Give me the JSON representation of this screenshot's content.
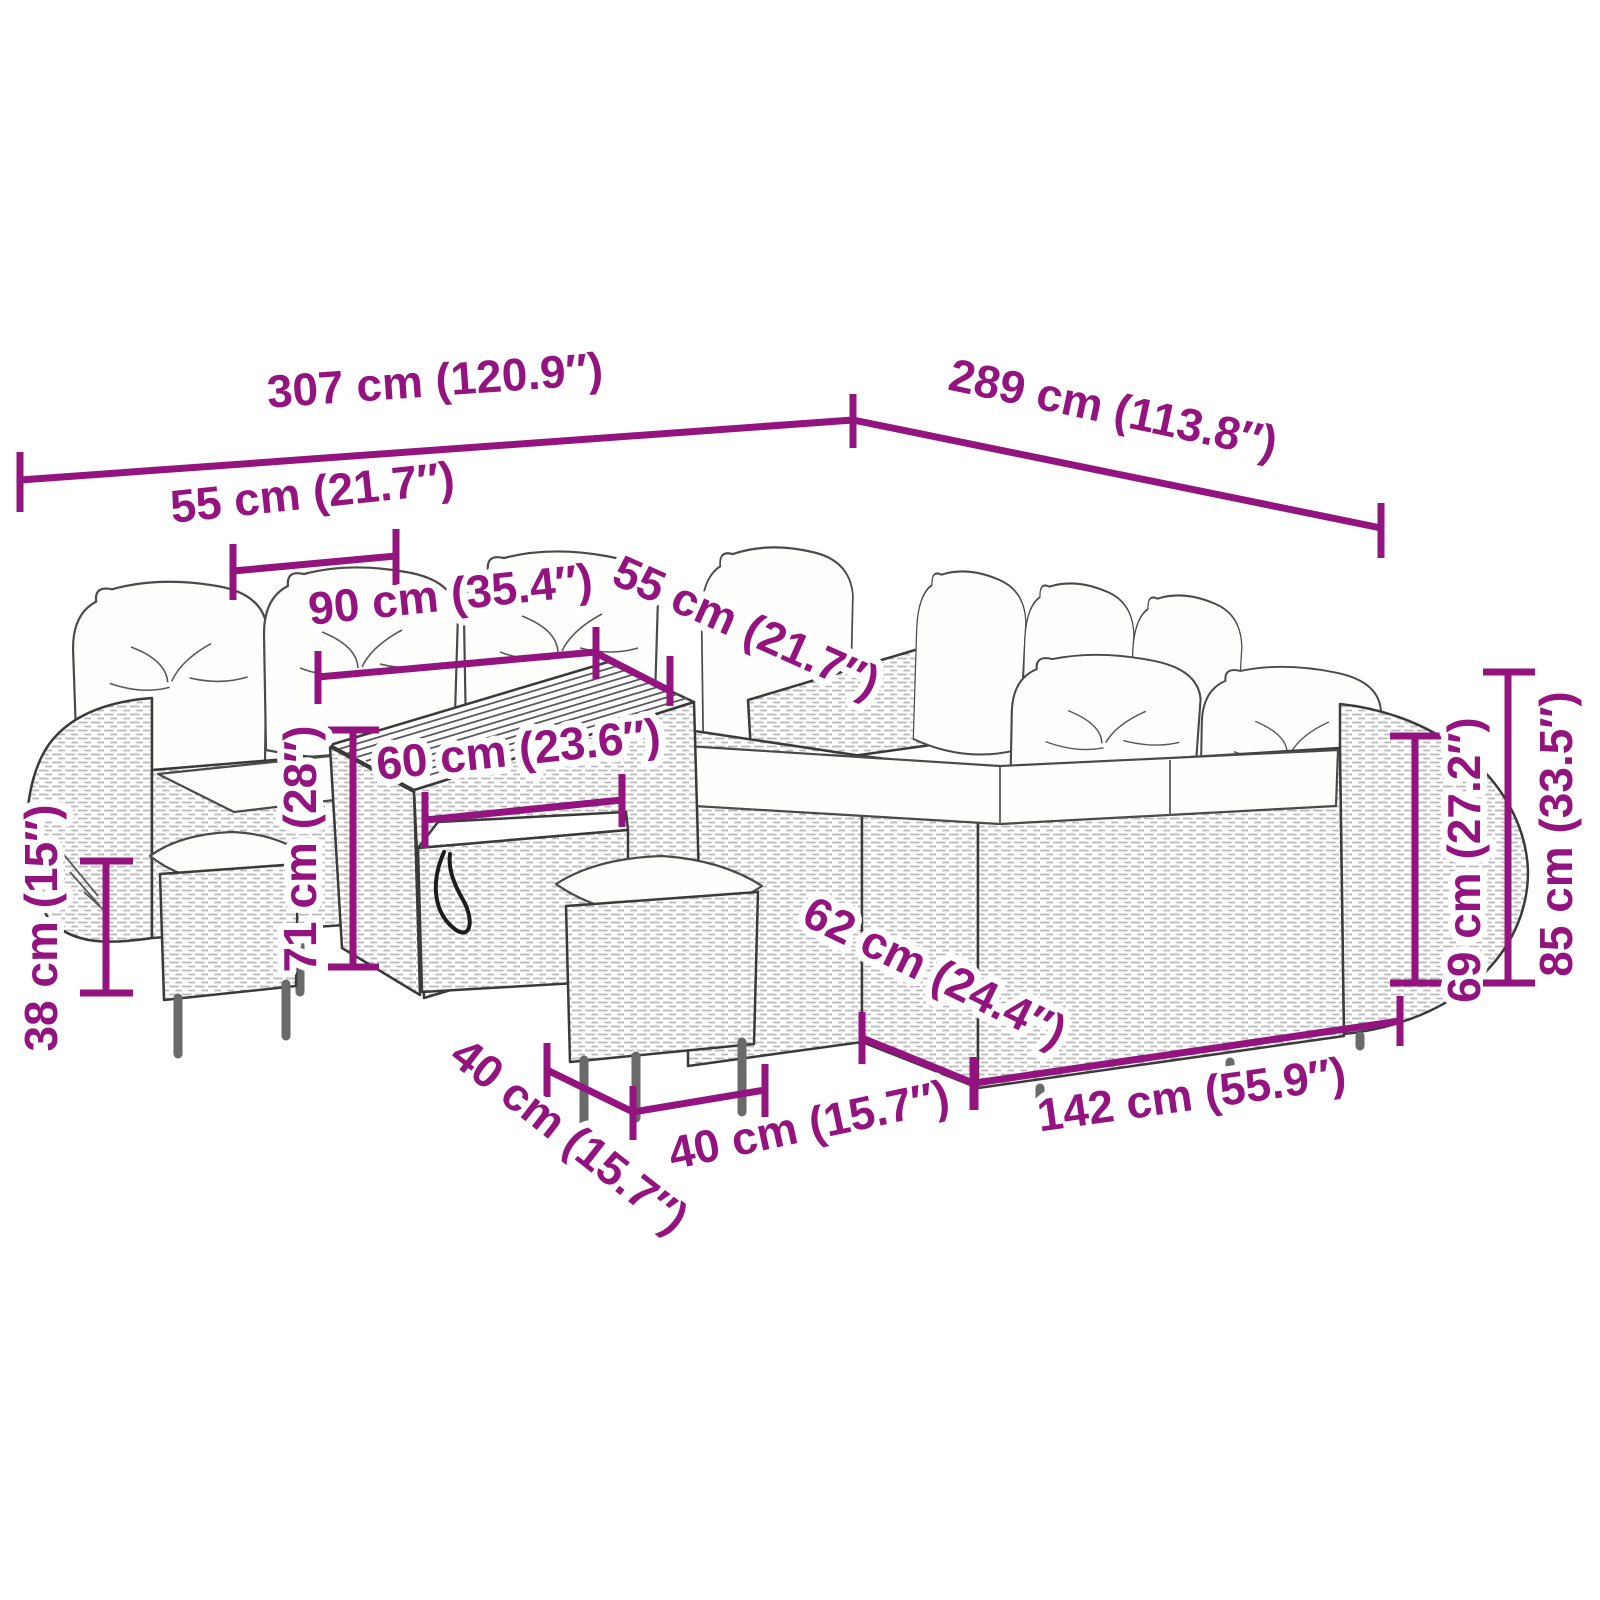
{
  "figure_title": "Garden furniture set dimension diagram",
  "colors": {
    "dimension_purple": "#93137F",
    "line_art_gray": "#3a3a3a",
    "cushion_white": "#fefefc",
    "background": "#ffffff"
  },
  "dims": {
    "total_width": {
      "label": "307 cm (120.9″)"
    },
    "total_depth": {
      "label": "289 cm (113.8″)"
    },
    "left_section_width": {
      "label": "55 cm (21.7″)"
    },
    "table_length": {
      "label": "90 cm (35.4″)"
    },
    "seat_depth": {
      "label": "55 cm (21.7″)"
    },
    "table_width": {
      "label": "60 cm (23.6″)"
    },
    "table_height": {
      "label": "71 cm (28″)"
    },
    "stool_height": {
      "label": "38 cm (15″)"
    },
    "right_seat_depth": {
      "label": "62 cm (24.4″)"
    },
    "stool_depth": {
      "label": "40 cm (15.7″)"
    },
    "stool_width": {
      "label": "40 cm (15.7″)"
    },
    "right_sofa_length": {
      "label": "142 cm (55.9″)"
    },
    "backrest_height": {
      "label": "69 cm (27.2″)"
    },
    "total_height": {
      "label": "85 cm (33.5″)"
    }
  }
}
